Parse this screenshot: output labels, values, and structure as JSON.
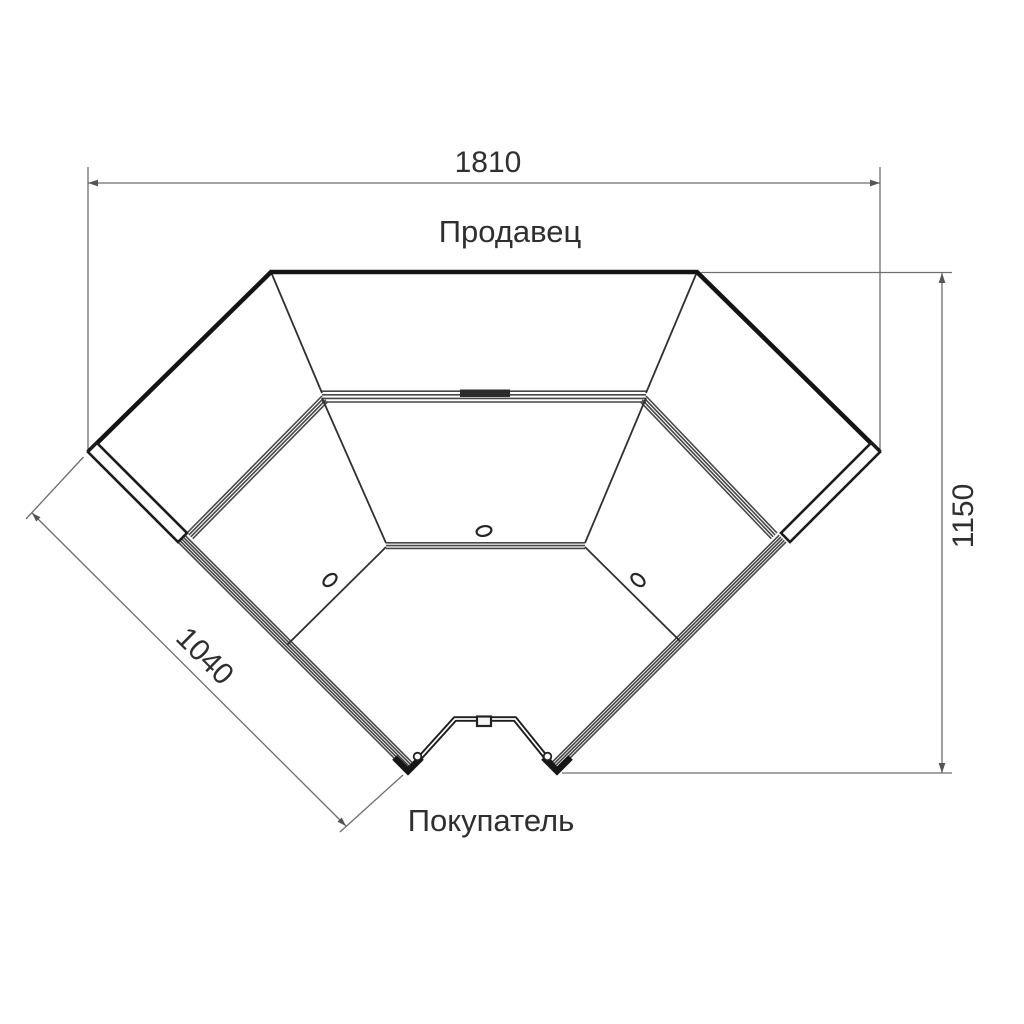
{
  "drawing": {
    "type": "plan-view technical drawing",
    "subject": "corner display counter unit, top view",
    "labels": {
      "seller": "Продавец",
      "buyer": "Покупатель"
    },
    "dimensions": {
      "overall_width": "1810",
      "overall_depth": "1150",
      "wing_length": "1040"
    },
    "colors": {
      "background": "#ffffff",
      "outline": "#141414",
      "band": "#474747",
      "dimension_line": "#6e6e6e",
      "text": "#2f2f2f"
    }
  }
}
